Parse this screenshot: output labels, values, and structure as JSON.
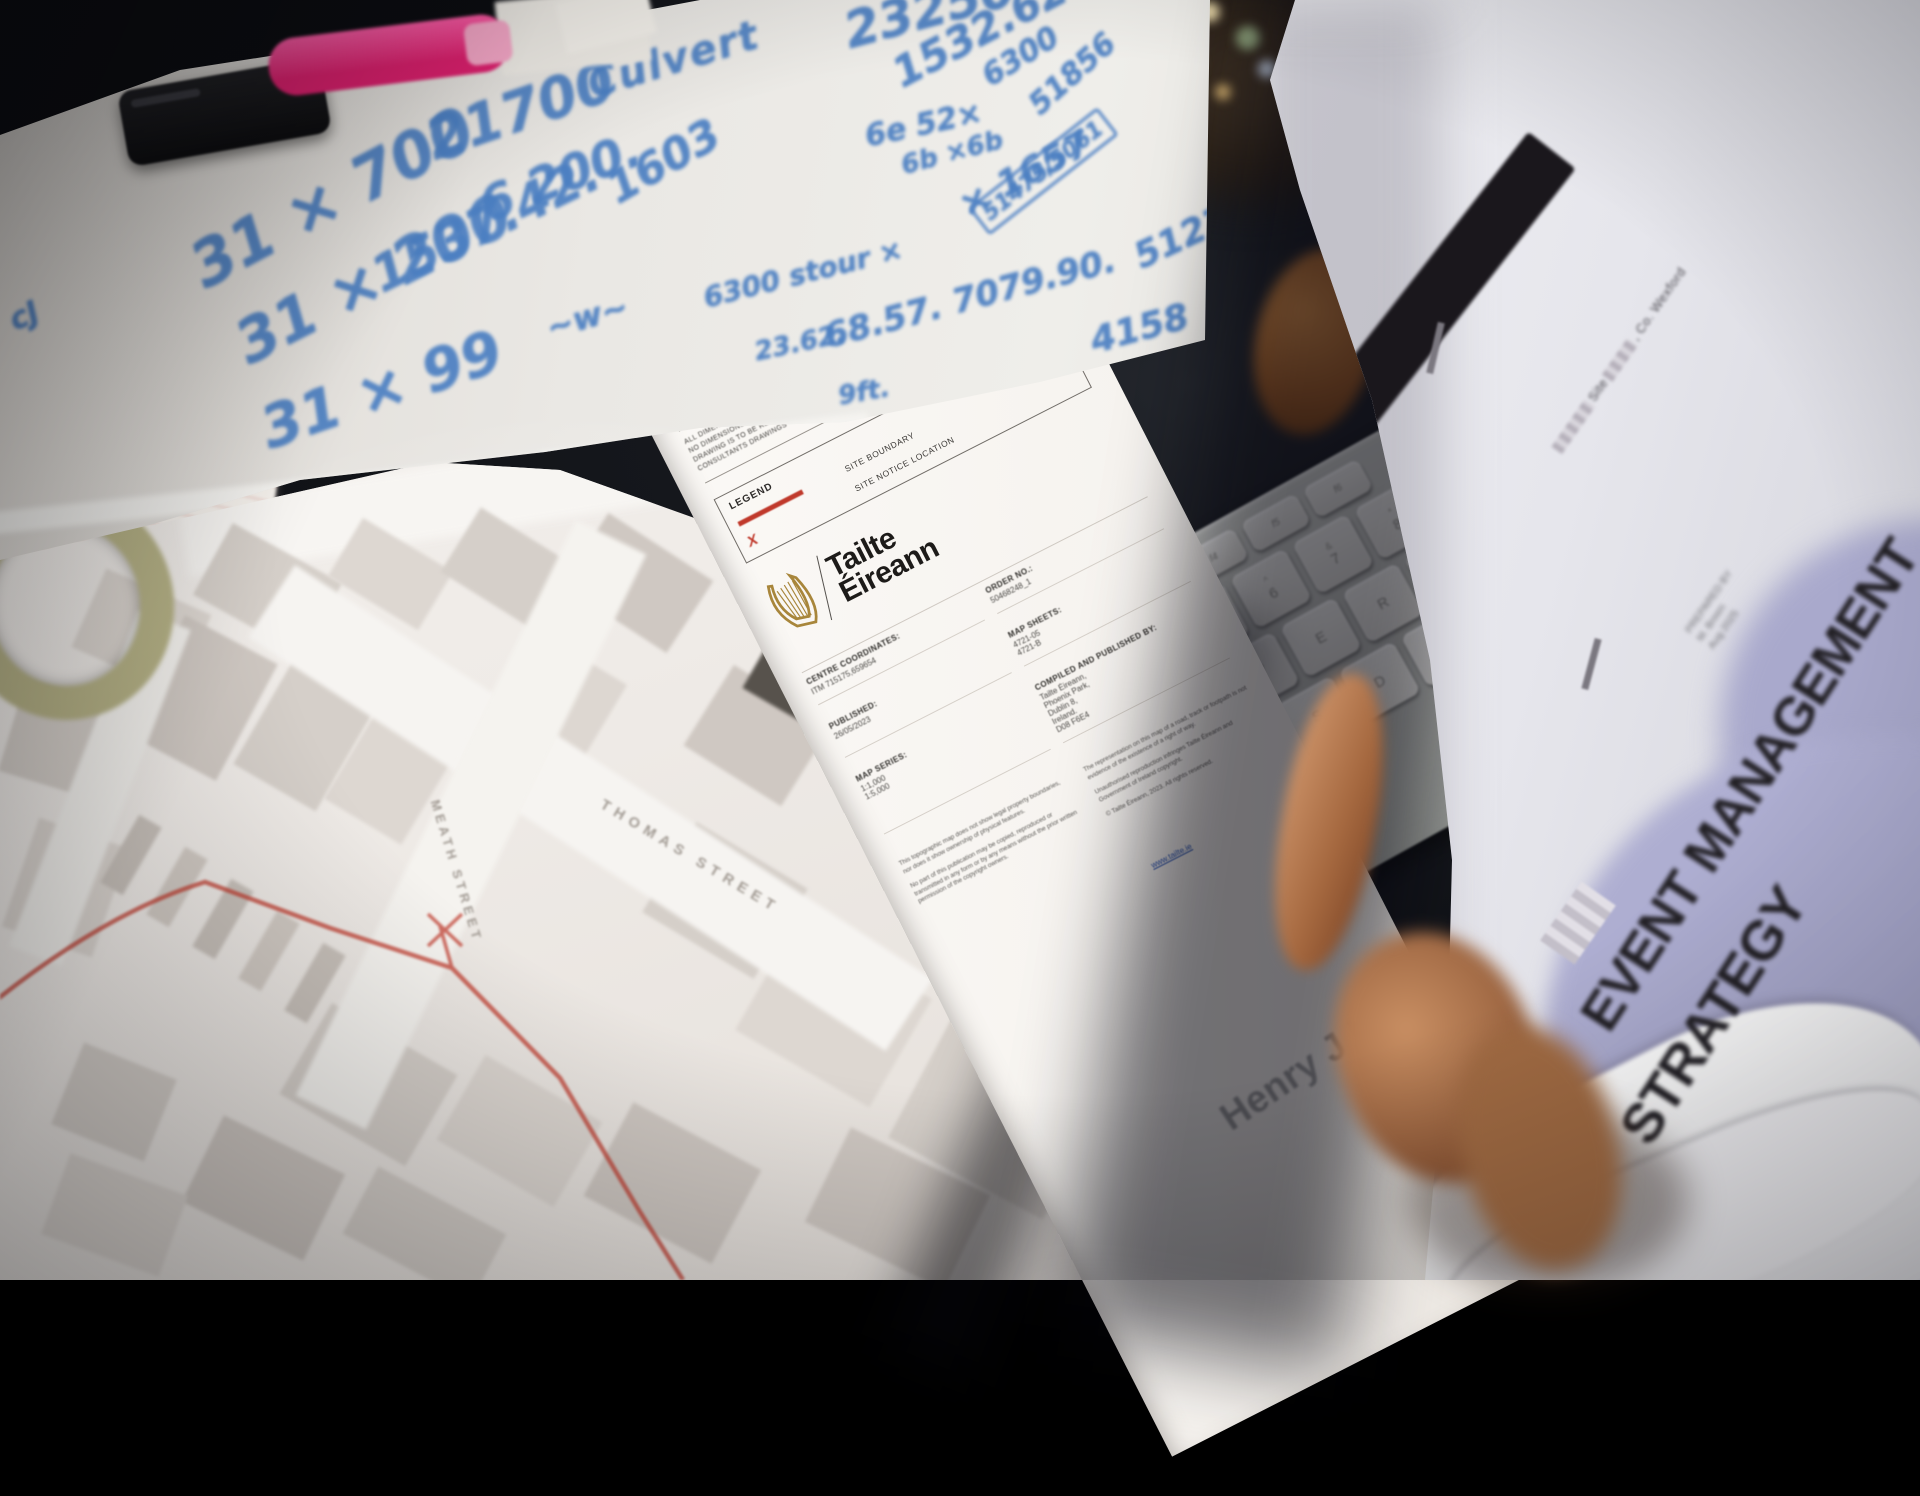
{
  "colors": {
    "marker_blue": "#4b7fc2",
    "boundary_red": "#c0392b",
    "harp_gold": "#a8863b",
    "lavender": "#a6a6cb",
    "marker_pink": "#e8357f"
  },
  "whiteboard": {
    "notes": [
      {
        "text": "21700",
        "style": "left:418px;top:112px;font-size:56px;transform:rotate(-19deg)"
      },
      {
        "text": "6 200.",
        "style": "left:472px;top:182px;font-size:48px;transform:rotate(-21deg)"
      },
      {
        "text": "Culvert",
        "style": "left:582px;top:64px;font-size:40px;transform:rotate(-17deg);letter-spacing:2px"
      },
      {
        "text": "1603",
        "style": "left:598px;top:170px;font-size:44px;transform:rotate(-30deg)"
      },
      {
        "text": "31 × 700",
        "style": "left:178px;top:238px;font-size:62px;transform:rotate(-28deg)"
      },
      {
        "text": "31 × 200",
        "style": "left:224px;top:316px;font-size:60px;transform:rotate(-27deg)"
      },
      {
        "text": "1537.42.",
        "style": "left:362px;top:252px;font-size:50px;transform:rotate(-26deg)"
      },
      {
        "text": "31 × 99",
        "style": "left:252px;top:398px;font-size:58px;transform:rotate(-19deg)"
      },
      {
        "text": "~w~",
        "style": "left:542px;top:310px;font-size:32px;transform:rotate(-16deg)"
      },
      {
        "text": "23250",
        "style": "left:838px;top:4px;font-size:50px;transform:rotate(-15deg)"
      },
      {
        "text": "1532.62",
        "style": "left:884px;top:54px;font-size:42px;transform:rotate(-28deg)"
      },
      {
        "text": "6300",
        "style": "left:976px;top:64px;font-size:30px;transform:rotate(-32deg)"
      },
      {
        "text": "51856",
        "style": "left:1022px;top:96px;font-size:30px;transform:rotate(-42deg)"
      },
      {
        "text": "6e 52×",
        "style": "left:862px;top:120px;font-size:30px;transform:rotate(-12deg)"
      },
      {
        "text": "6b ×6b",
        "style": "left:898px;top:152px;font-size:26px;transform:rotate(-15deg)"
      },
      {
        "text": "× 1657",
        "style": "left:952px;top:190px;font-size:36px;transform:rotate(-28deg)"
      },
      {
        "text": "51475/5061",
        "style": "left:968px;top:208px;font-size:22px;transform:rotate(-38deg);border:3px solid #4d80c4;padding:2px 6px;border-radius:4px"
      },
      {
        "text": "51277",
        "style": "left:1128px;top:240px;font-size:36px;transform:rotate(-25deg)"
      },
      {
        "text": "6300 stour ×",
        "style": "left:700px;top:282px;font-size:28px;transform:rotate(-14deg)"
      },
      {
        "text": "23.62.",
        "style": "left:752px;top:338px;font-size:26px;transform:rotate(-12deg)"
      },
      {
        "text": "68.57. 7079.90.",
        "style": "left:820px;top:318px;font-size:34px;transform:rotate(-15deg)"
      },
      {
        "text": "4158",
        "style": "left:1086px;top:322px;font-size:36px;transform:rotate(-15deg)"
      },
      {
        "text": "9ft.",
        "style": "left:836px;top:382px;font-size:26px;transform:rotate(-10deg)"
      },
      {
        "text": "cJ",
        "style": "left:4px;top:306px;font-size:30px;transform:rotate(-24deg)"
      }
    ]
  },
  "map": {
    "street_labels": [
      {
        "text": "THOMAS STREET",
        "style": "left:606px;top:796px;transform:rotate(31deg)"
      },
      {
        "text": "MEATH STREET",
        "style": "left:442px;top:798px;transform:rotate(73deg);font-size:13px;letter-spacing:4px"
      }
    ],
    "buildings": [
      {
        "style": "left:205px;top:548px;width:125px;height:82px;transform:rotate(29deg)"
      },
      {
        "style": "left:338px;top:540px;width:105px;height:68px;transform:rotate(31deg);background:#ddd7d1"
      },
      {
        "style": "left:452px;top:532px;width:115px;height:76px;transform:rotate(32deg)"
      },
      {
        "style": "left:575px;top:540px;width:125px;height:86px;transform:rotate(33deg);background:#cfc8c2"
      },
      {
        "style": "left:84px;top:588px;width:115px;height:86px;transform:rotate(24deg);background:#ddd7d1"
      },
      {
        "style": "left:10px;top:692px;width:105px;height:96px;transform:rotate(17deg)"
      },
      {
        "style": "left:148px;top:632px;width:105px;height:132px;transform:rotate(28deg);background:#cfc8c2"
      },
      {
        "style": "left:258px;top:672px;width:95px;height:124px;transform:rotate(30deg)"
      },
      {
        "style": "left:348px;top:712px;width:90px;height:118px;transform:rotate(31deg);background:#ddd7d1"
      },
      {
        "style": "left:508px;top:652px;width:95px;height:120px;transform:rotate(31deg);background:#ddd7d1"
      },
      {
        "style": "left:700px;top:688px;width:115px;height:95px;transform:rotate(32deg);background:#cfc8c2"
      },
      {
        "style": "left:752px;top:652px;width:88px;height:62px;transform:rotate(30deg);background:#57524c"
      },
      {
        "style": "left:18px;top:830px;width:95px;height:115px;transform:rotate(19deg);background:#ddd7d1"
      },
      {
        "style": "left:118px;top:816px;width:26px;height:78px;transform:rotate(30deg);background:#c8c1ba"
      },
      {
        "style": "left:164px;top:848px;width:26px;height:78px;transform:rotate(30deg);background:#d1cac3"
      },
      {
        "style": "left:210px;top:880px;width:26px;height:78px;transform:rotate(30deg);background:#c8c1ba"
      },
      {
        "style": "left:256px;top:912px;width:26px;height:78px;transform:rotate(30deg);background:#d1cac3"
      },
      {
        "style": "left:302px;top:944px;width:26px;height:78px;transform:rotate(30deg);background:#c8c1ba"
      },
      {
        "style": "left:296px;top:1032px;width:145px;height:105px;transform:rotate(30deg)"
      },
      {
        "style": "left:452px;top:1082px;width:135px;height:98px;transform:rotate(30deg);background:#ddd7d1"
      },
      {
        "style": "left:600px;top:1130px;width:145px;height:106px;transform:rotate(28deg);background:#cfc8c2"
      },
      {
        "style": "left:196px;top:1140px;width:135px;height:96px;transform:rotate(26deg);background:#cfc8c2"
      },
      {
        "style": "left:64px;top:1058px;width:100px;height:88px;transform:rotate(22deg)"
      },
      {
        "style": "left:52px;top:1172px;width:125px;height:86px;transform:rotate(20deg);background:#ddd7d1"
      },
      {
        "style": "left:352px;top:1196px;width:145px;height:76px;transform:rotate(28deg)"
      },
      {
        "style": "left:756px;top:952px;width:155px;height:125px;transform:rotate(30deg);background:#ddd7d1"
      },
      {
        "style": "left:912px;top:1042px;width:175px;height:145px;transform:rotate(28deg)"
      },
      {
        "style": "left:820px;top:1156px;width:155px;height:105px;transform:rotate(26deg);background:#cfc8c2"
      },
      {
        "style": "left:660px;top:848px;width:130px;height:105px;transform:rotate(31deg)"
      }
    ]
  },
  "tailte": {
    "disclaimer_lines": [
      "ALL DIMENSIONS TO BE CHECKED ON SITE",
      "NO DIMENSIONS TO BE SCALED FROM THIS DRAWING",
      "DRAWING IS TO BE READ IN CONJUNCTION WITH RELEVANT",
      "CONSULTANTS DRAWINGS"
    ],
    "legend": {
      "title": "LEGEND",
      "boundary_label": "SITE BOUNDARY",
      "notice_label": "SITE NOTICE LOCATION",
      "x_mark": "X"
    },
    "brand": {
      "line1": "Tailte",
      "line2": "Éireann"
    },
    "fields": [
      {
        "label": "CENTRE COORDINATES:",
        "value": "ITM   715175,659654"
      },
      {
        "label": "ORDER NO.:",
        "value": "50468248_1"
      },
      {
        "label": "PUBLISHED:",
        "value": "26/05/2023"
      },
      {
        "label": "MAP SHEETS:",
        "value": "4721-05\n4721-B"
      },
      {
        "label": "MAP SERIES:",
        "value": "1:1,000\n1:5,000"
      },
      {
        "label": "COMPILED AND PUBLISHED BY:",
        "value": "Tailte Éireann,\nPhoenix Park,\nDublin 8,\nIreland.\nD08 F6E4"
      }
    ],
    "website": "www.tailte.ie",
    "fineprint": [
      "This topographic map does not show legal property boundaries, nor does it show ownership of physical features.",
      "No part of this publication may be copied, reproduced or transmitted in any form or by any means without the prior written permission of the copyright owners.",
      "The representation on this map of a road, track or footpath is not evidence of the existence of a right of way.",
      "Unauthorised reproduction infringes Tailte Éireann and Government of Ireland copyright.",
      "© Tailte Éireann, 2023. All rights reserved."
    ],
    "architect": "Henry J Lyons"
  },
  "booklet": {
    "subtitle_site": "Site",
    "subtitle_region": ", Co. Wexford",
    "title_line1": "EVENT MANAGEMENT",
    "title_line2": "STRATEGY",
    "prepared_lines": [
      "PREPARED BY",
      "M. Breen",
      "Aug 2025"
    ]
  },
  "keyboard": {
    "row_f": [
      {
        "m": "f3"
      },
      {
        "m": "f4"
      },
      {
        "m": "f5"
      },
      {
        "m": "f6"
      }
    ],
    "row_num": [
      {
        "s": "$",
        "m": "4"
      },
      {
        "s": "%",
        "m": "5"
      },
      {
        "s": "^",
        "m": "6"
      },
      {
        "s": "&",
        "m": "7"
      },
      {
        "s": "*",
        "m": "8"
      }
    ],
    "row_q": [
      {
        "m": "Q"
      },
      {
        "m": "W"
      },
      {
        "m": "E"
      },
      {
        "m": "R"
      },
      {
        "m": "T"
      },
      {
        "m": "Y"
      }
    ],
    "row_a": [
      {
        "m": "A"
      },
      {
        "m": "S"
      },
      {
        "m": "D"
      },
      {
        "m": "F"
      },
      {
        "m": "G"
      }
    ]
  }
}
